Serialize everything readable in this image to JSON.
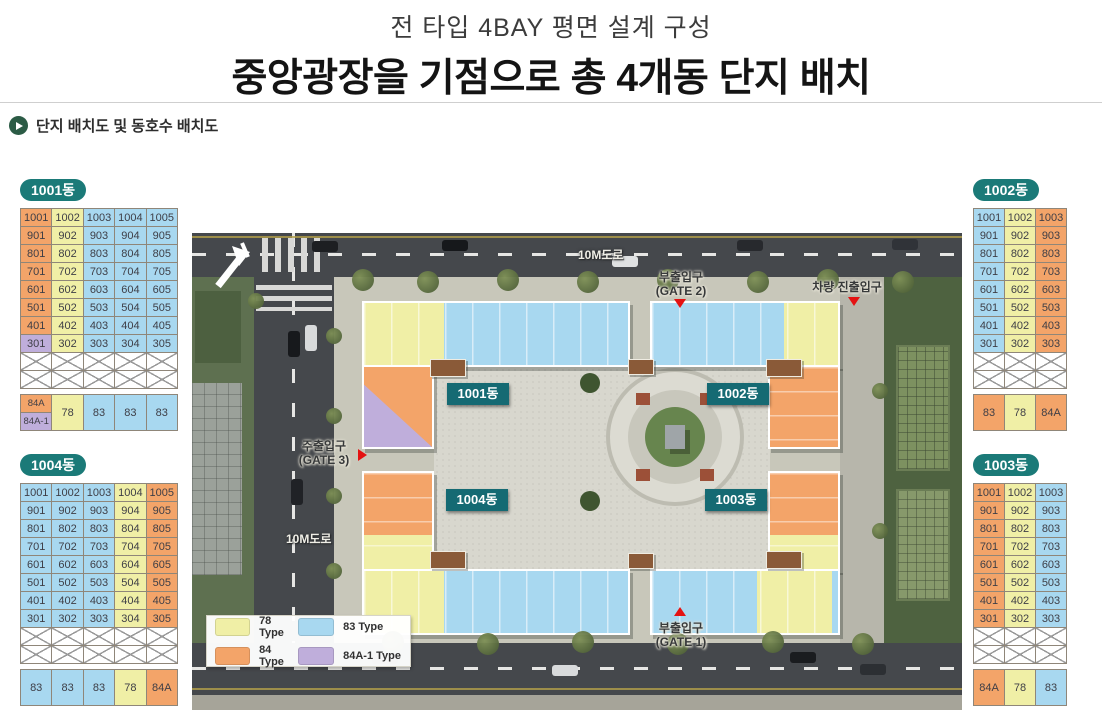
{
  "header": {
    "subtitle": "전 타입 4BAY 평면 설계 구성",
    "title": "중앙광장을 기점으로 총 4개동 단지 배치"
  },
  "section": {
    "label": "단지 배치도 및 동호수 배치도"
  },
  "colors": {
    "t78": "#f0efa6",
    "t83": "#a8d8f0",
    "t84": "#f3a469",
    "t84a1": "#bfaedb",
    "badge_teal": "#1b7a78",
    "map_badge_teal": "#156a73",
    "marker_red": "#e41212",
    "section_green": "#2b5b45"
  },
  "tables": [
    {
      "name": "1001동",
      "cols": 5,
      "col_types": [
        "t84",
        "t78",
        "t83",
        "t83",
        "t83"
      ],
      "overrides": [
        {
          "row": 7,
          "col": 0,
          "type": "t84a1"
        }
      ],
      "rows": [
        [
          "1001",
          "1002",
          "1003",
          "1004",
          "1005"
        ],
        [
          "901",
          "902",
          "903",
          "904",
          "905"
        ],
        [
          "801",
          "802",
          "803",
          "804",
          "805"
        ],
        [
          "701",
          "702",
          "703",
          "704",
          "705"
        ],
        [
          "601",
          "602",
          "603",
          "604",
          "605"
        ],
        [
          "501",
          "502",
          "503",
          "504",
          "505"
        ],
        [
          "401",
          "402",
          "403",
          "404",
          "405"
        ],
        [
          "301",
          "302",
          "303",
          "304",
          "305"
        ]
      ],
      "x_rows": 2,
      "type_row": {
        "split_first": [
          {
            "label": "84A",
            "type": "t84"
          },
          {
            "label": "84A-1",
            "type": "t84a1"
          }
        ],
        "cells": [
          {
            "label": "78",
            "type": "t78"
          },
          {
            "label": "83",
            "type": "t83"
          },
          {
            "label": "83",
            "type": "t83"
          },
          {
            "label": "83",
            "type": "t83"
          }
        ]
      }
    },
    {
      "name": "1002동",
      "cols": 3,
      "col_types": [
        "t83",
        "t78",
        "t84"
      ],
      "rows": [
        [
          "1001",
          "1002",
          "1003"
        ],
        [
          "901",
          "902",
          "903"
        ],
        [
          "801",
          "802",
          "803"
        ],
        [
          "701",
          "702",
          "703"
        ],
        [
          "601",
          "602",
          "603"
        ],
        [
          "501",
          "502",
          "503"
        ],
        [
          "401",
          "402",
          "403"
        ],
        [
          "301",
          "302",
          "303"
        ]
      ],
      "x_rows": 2,
      "type_row": {
        "cells": [
          {
            "label": "83",
            "type": "t84"
          },
          {
            "label": "78",
            "type": "t78"
          },
          {
            "label": "84A",
            "type": "t84"
          }
        ]
      }
    },
    {
      "name": "1004동",
      "cols": 5,
      "col_types": [
        "t83",
        "t83",
        "t83",
        "t78",
        "t84"
      ],
      "rows": [
        [
          "1001",
          "1002",
          "1003",
          "1004",
          "1005"
        ],
        [
          "901",
          "902",
          "903",
          "904",
          "905"
        ],
        [
          "801",
          "802",
          "803",
          "804",
          "805"
        ],
        [
          "701",
          "702",
          "703",
          "704",
          "705"
        ],
        [
          "601",
          "602",
          "603",
          "604",
          "605"
        ],
        [
          "501",
          "502",
          "503",
          "504",
          "505"
        ],
        [
          "401",
          "402",
          "403",
          "404",
          "405"
        ],
        [
          "301",
          "302",
          "303",
          "304",
          "305"
        ]
      ],
      "x_rows": 2,
      "type_row": {
        "cells": [
          {
            "label": "83",
            "type": "t83"
          },
          {
            "label": "83",
            "type": "t83"
          },
          {
            "label": "83",
            "type": "t83"
          },
          {
            "label": "78",
            "type": "t78"
          },
          {
            "label": "84A",
            "type": "t84"
          }
        ]
      }
    },
    {
      "name": "1003동",
      "cols": 3,
      "col_types": [
        "t84",
        "t78",
        "t83"
      ],
      "rows": [
        [
          "1001",
          "1002",
          "1003"
        ],
        [
          "901",
          "902",
          "903"
        ],
        [
          "801",
          "802",
          "803"
        ],
        [
          "701",
          "702",
          "703"
        ],
        [
          "601",
          "602",
          "603"
        ],
        [
          "501",
          "502",
          "503"
        ],
        [
          "401",
          "402",
          "403"
        ],
        [
          "301",
          "302",
          "303"
        ]
      ],
      "x_rows": 2,
      "type_row": {
        "cells": [
          {
            "label": "84A",
            "type": "t84"
          },
          {
            "label": "78",
            "type": "t78"
          },
          {
            "label": "83",
            "type": "t83"
          }
        ]
      }
    }
  ],
  "map": {
    "road_top_label": "10M도로",
    "road_left_label": "10M도로",
    "gates": {
      "gate2": {
        "line1": "부출입구",
        "line2": "(GATE 2)"
      },
      "vehicle": {
        "line1": "차량 진출입구"
      },
      "gate3": {
        "line1": "주출입구",
        "line2": "(GATE 3)"
      },
      "gate1": {
        "line1": "부출입구",
        "line2": "(GATE 1)"
      }
    },
    "building_badges": {
      "b1001": "1001동",
      "b1002": "1002동",
      "b1004": "1004동",
      "b1003": "1003동"
    },
    "legend": {
      "items": [
        {
          "label": "78 Type",
          "type": "t78"
        },
        {
          "label": "83 Type",
          "type": "t83"
        },
        {
          "label": "84 Type",
          "type": "t84"
        },
        {
          "label": "84A-1 Type",
          "type": "t84a1"
        }
      ]
    }
  }
}
